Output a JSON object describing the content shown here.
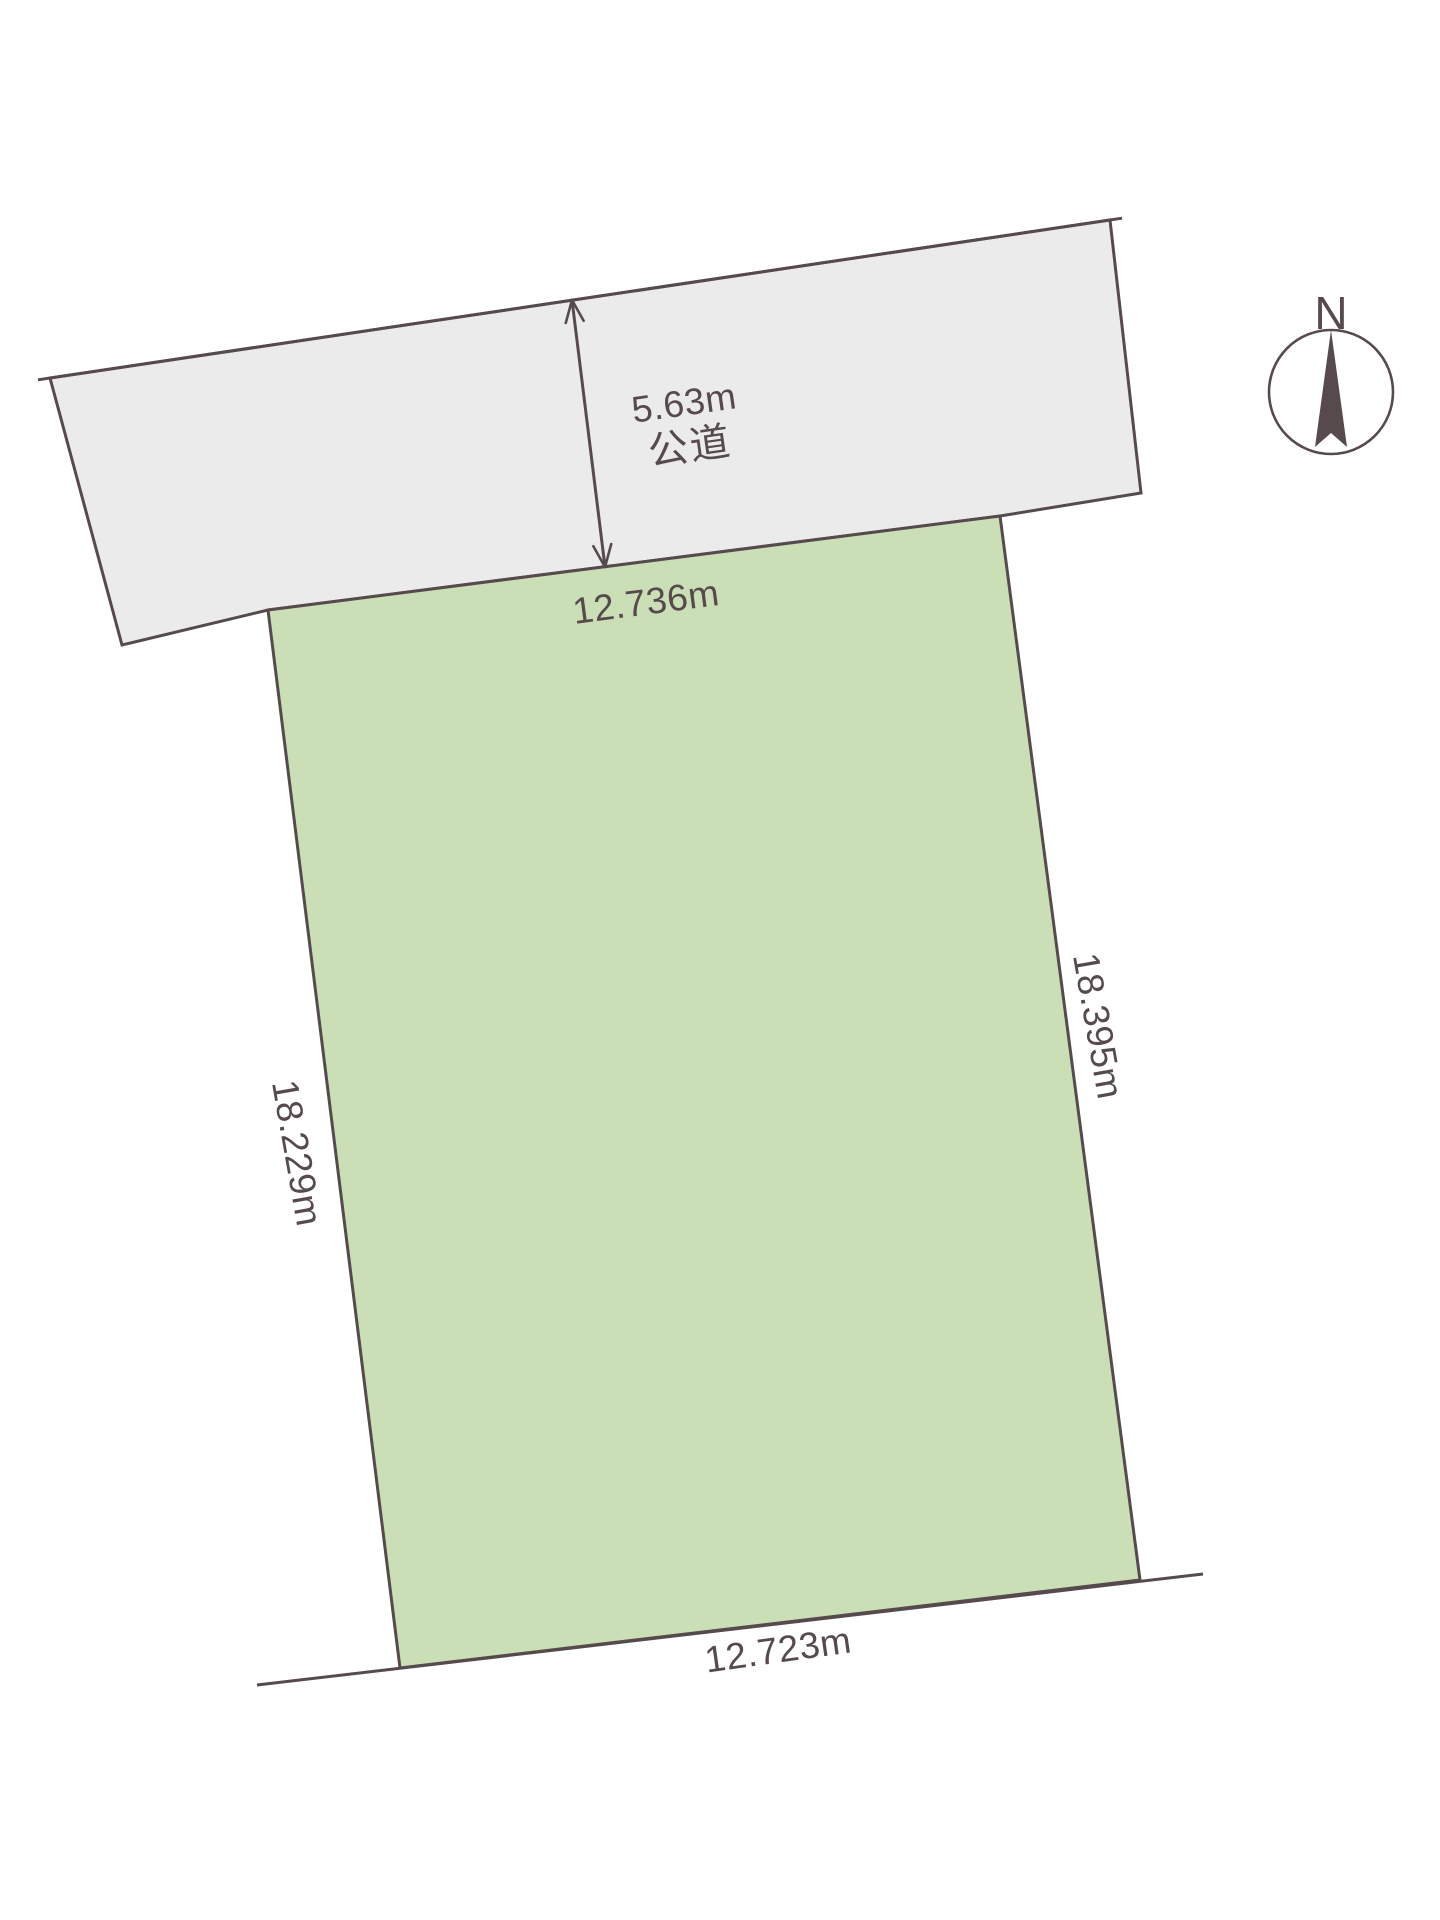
{
  "compass": {
    "north_label": "N"
  },
  "road": {
    "width_label": "5.63m",
    "name_label": "公道"
  },
  "parcel": {
    "top_edge_label": "12.736m",
    "right_edge_label": "18.395m",
    "left_edge_label": "18.229m",
    "bottom_edge_label": "12.723m"
  },
  "colors": {
    "road_fill": "#ECEBEC",
    "parcel_fill": "#CBDFB7",
    "line": "#574A4D",
    "text": "#574A4D",
    "background": "#FFFFFF"
  }
}
